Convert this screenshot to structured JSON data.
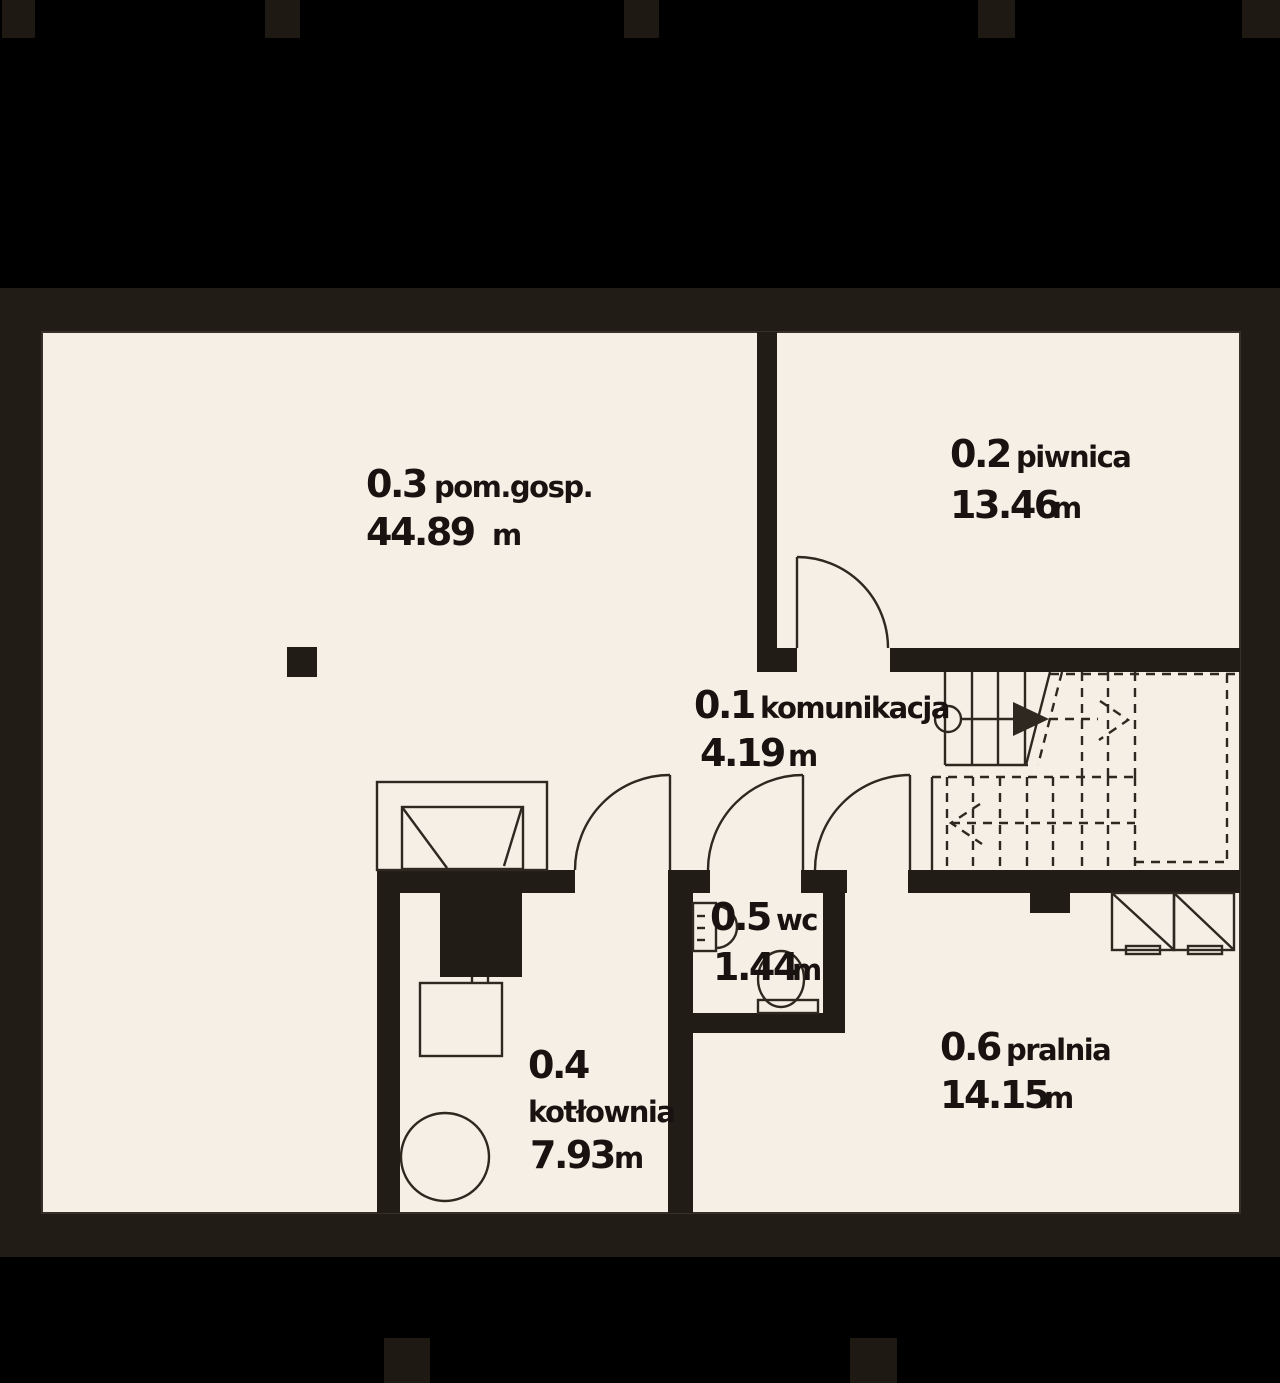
{
  "plan": {
    "level_type": "basement-floor-plan",
    "unit_label": "m",
    "rooms": [
      {
        "number": "0.1",
        "name": "komunikacja",
        "area": "4.19",
        "unit": "m"
      },
      {
        "number": "0.2",
        "name": "piwnica",
        "area": "13.46",
        "unit": "m"
      },
      {
        "number": "0.3",
        "name": "pom.gosp.",
        "area": "44.89",
        "unit": "m"
      },
      {
        "number": "0.4",
        "name": "kotłownia",
        "area": "7.93",
        "unit": "m"
      },
      {
        "number": "0.5",
        "name": "wc",
        "area": "1.44",
        "unit": "m"
      },
      {
        "number": "0.6",
        "name": "pralnia",
        "area": "14.15",
        "unit": "m"
      }
    ],
    "colors": {
      "page_background": "#000000",
      "wall": "#211c16",
      "floor": "#f5efe6",
      "line": "#2e2820",
      "text": "#181310",
      "crop_mark": "#1e1913"
    }
  }
}
